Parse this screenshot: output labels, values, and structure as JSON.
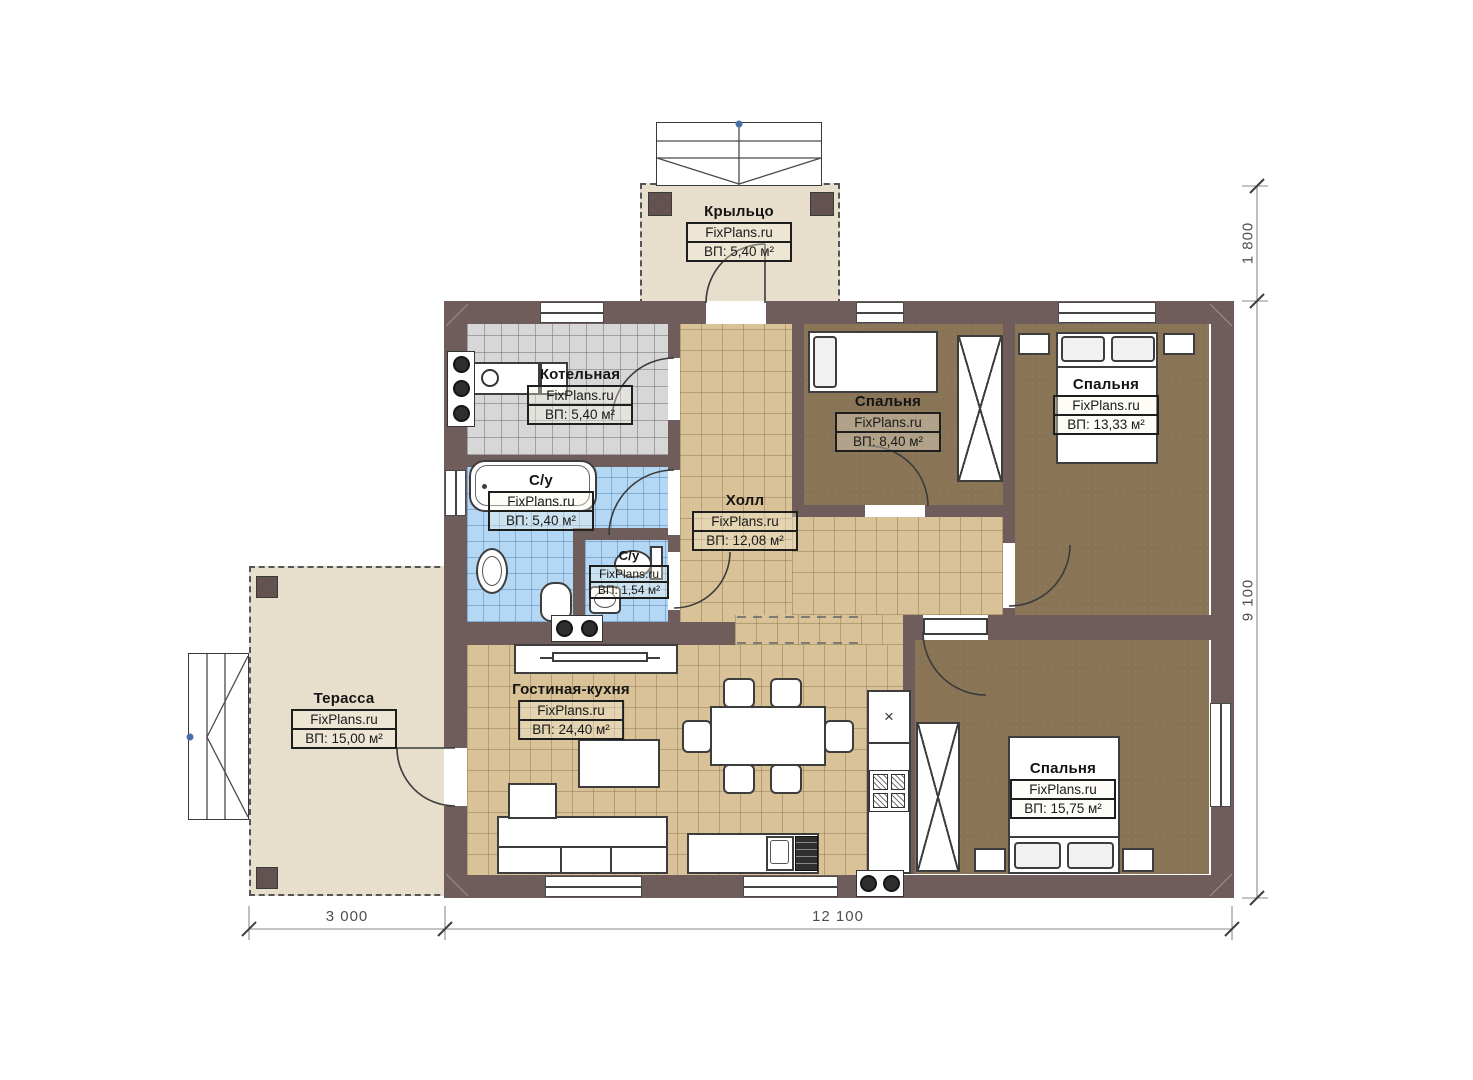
{
  "plan": {
    "brand": "FixPlans.ru",
    "rooms": [
      {
        "name": "Крыльцо",
        "brand": "FixPlans.ru",
        "area": "ВП: 5,40 м²"
      },
      {
        "name": "Котельная",
        "brand": "FixPlans.ru",
        "area": "ВП: 5,40 м²"
      },
      {
        "name": "С/у",
        "brand": "FixPlans.ru",
        "area": "ВП: 5,40 м²"
      },
      {
        "name": "С/у",
        "brand": "FixPlans.ru",
        "area": "ВП: 1,54 м²"
      },
      {
        "name": "Холл",
        "brand": "FixPlans.ru",
        "area": "ВП: 12,08 м²"
      },
      {
        "name": "Спальня",
        "brand": "FixPlans.ru",
        "area": "ВП: 8,40 м²"
      },
      {
        "name": "Спальня",
        "brand": "FixPlans.ru",
        "area": "ВП: 13,33 м²"
      },
      {
        "name": "Гостиная-кухня",
        "brand": "FixPlans.ru",
        "area": "ВП: 24,40 м²"
      },
      {
        "name": "Спальня",
        "brand": "FixPlans.ru",
        "area": "ВП: 15,75 м²"
      },
      {
        "name": "Терасса",
        "brand": "FixPlans.ru",
        "area": "ВП: 15,00 м²"
      }
    ],
    "dimensions": {
      "porch_depth": "1 800",
      "house_side": "9 100",
      "terrace_width": "3 000",
      "house_width": "12 100"
    },
    "symbols": {
      "fridge_mark": "×"
    },
    "colors": {
      "wall": "#6e5d5b",
      "floor_tile_tan": "#d9c297",
      "floor_bedroom_brown": "#8a7456",
      "floor_bath_blue": "#b4d8f3",
      "floor_boiler_gray": "#d7d7d7",
      "deck_beige": "#e7decb"
    }
  }
}
